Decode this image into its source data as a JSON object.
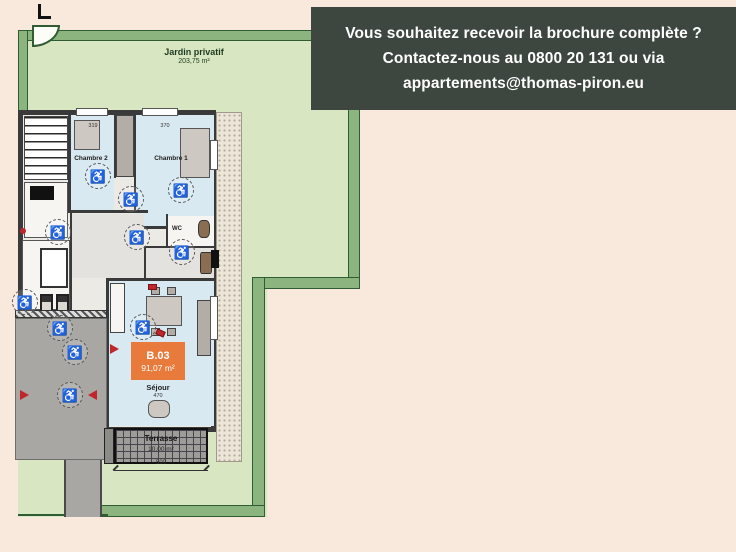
{
  "page": {
    "background_color": "#f9e9dc"
  },
  "banner": {
    "background_color": "#3d463f",
    "text_color": "#ffffff",
    "line1": "Vous souhaitez recevoir la brochure complète ?",
    "line2": "Contactez-nous au 0800 20 131 ou via",
    "line3": "appartements@thomas-piron.eu",
    "phone": "0800 20 131",
    "email": "appartements@thomas-piron.eu"
  },
  "garden": {
    "label": "Jardin privatif",
    "area": "203,75 m²",
    "lawn_color": "#d9e6c2",
    "hedge_color": "#8cb47f"
  },
  "plan": {
    "rooms": {
      "chambre2": "Chambre 2",
      "chambre1": "Chambre 1",
      "wc": "WC",
      "sejour": "Séjour"
    },
    "unit": {
      "code": "B.03",
      "area": "91,07 m²",
      "badge_color": "#e87a3c"
    },
    "terrace": {
      "label": "Terrasse",
      "area": "10,00 m²"
    },
    "dimensions": {
      "chambre2_width": "319",
      "chambre1_width": "370",
      "sejour_width": "470",
      "terrace_width": "500"
    }
  },
  "icons": {
    "wheelchair": "♿"
  }
}
